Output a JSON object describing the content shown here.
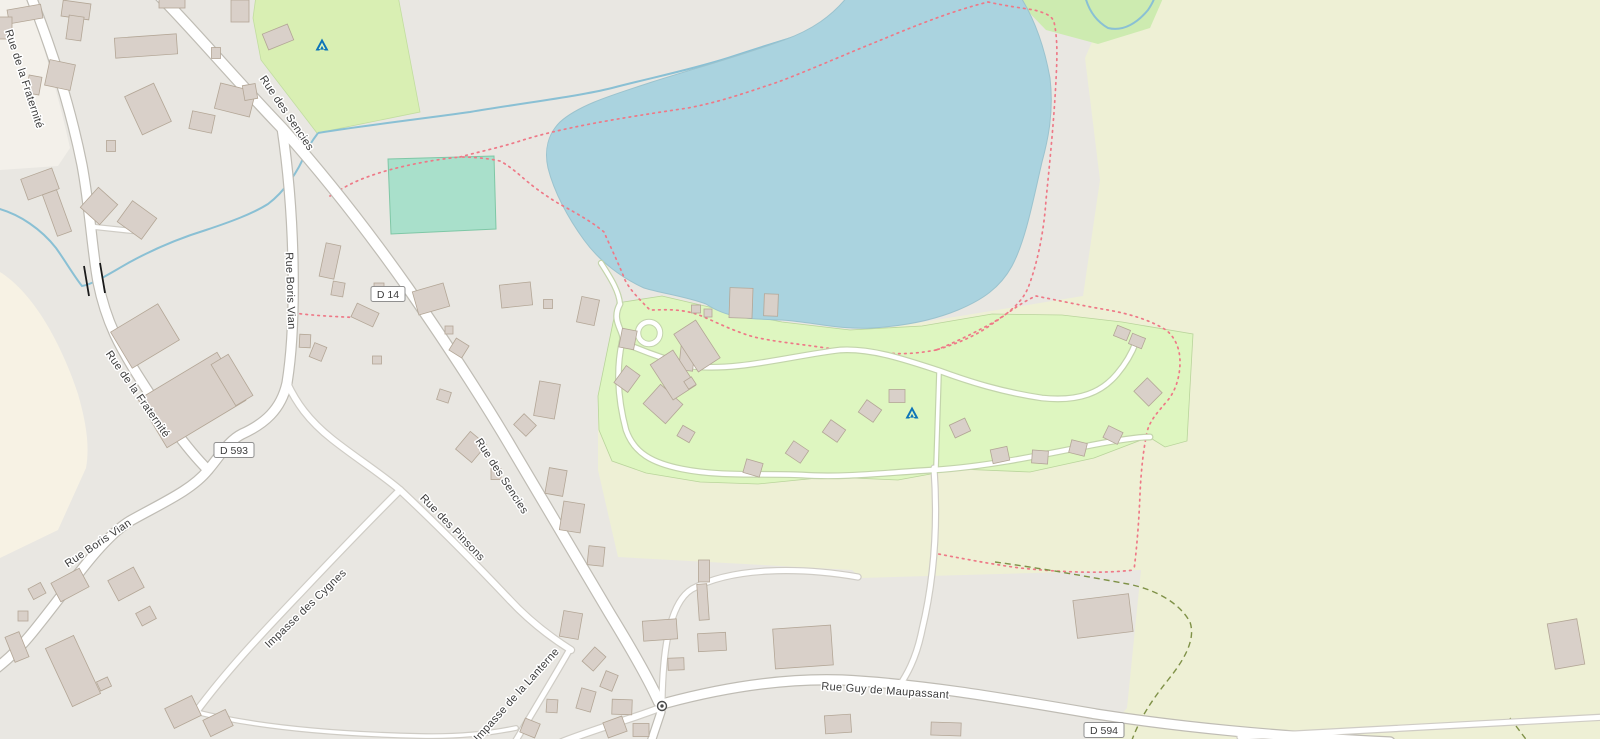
{
  "map": {
    "labels": [
      {
        "id": "fraternite-1",
        "text": "Rue de la Fraternité",
        "x": 21,
        "y": 80,
        "rot": 72
      },
      {
        "id": "fraternite-2",
        "text": "Rue de la Fraternité",
        "x": 135,
        "y": 396,
        "rot": 55
      },
      {
        "id": "sencies-1",
        "text": "Rue des Sencies",
        "x": 284,
        "y": 115,
        "rot": 56
      },
      {
        "id": "sencies-2",
        "text": "Rue des Sencies",
        "x": 499,
        "y": 478,
        "rot": 57
      },
      {
        "id": "boris-vian-1",
        "text": "Rue Boris Vian",
        "x": 287,
        "y": 291,
        "rot": 88
      },
      {
        "id": "boris-vian-2",
        "text": "Rue Boris Vian",
        "x": 100,
        "y": 546,
        "rot": -34
      },
      {
        "id": "pinsons",
        "text": "Rue des Pinsons",
        "x": 450,
        "y": 530,
        "rot": 46
      },
      {
        "id": "cygnes",
        "text": "Impasse des Cygnes",
        "x": 308,
        "y": 611,
        "rot": -44
      },
      {
        "id": "lanterne",
        "text": "Impasse de la Lanterne",
        "x": 519,
        "y": 697,
        "rot": -48
      },
      {
        "id": "maupassant",
        "text": "Rue Guy de Maupassant",
        "x": 885,
        "y": 694,
        "rot": 4
      }
    ],
    "shields": [
      {
        "id": "d14",
        "ref": "D 14",
        "x": 388,
        "y": 294,
        "w": 34,
        "h": 15
      },
      {
        "id": "d593",
        "ref": "D 593",
        "x": 234,
        "y": 450,
        "w": 40,
        "h": 15
      },
      {
        "id": "d594",
        "ref": "D 594",
        "x": 1104,
        "y": 730,
        "w": 40,
        "h": 15
      }
    ],
    "markers": {
      "campsites": [
        {
          "x": 322,
          "y": 45
        },
        {
          "x": 912,
          "y": 413
        }
      ],
      "mini_roundabout": {
        "x": 662,
        "y": 706
      }
    },
    "palette": {
      "base": "#e9e7e2",
      "light_area": "#f3f0ea",
      "cream": "#f7f2e4",
      "farmland": "#eef0d5",
      "campsite": "#def6c0",
      "grass": "#d9efb3",
      "grass2": "#cdebb0",
      "water": "#aad3df",
      "pitch": "#a9e0cb",
      "road_fill": "#ffffff",
      "road_casing": "#bfbcb4",
      "road_casing_minor": "#cfccc5",
      "path_casing_green": "#c3d4ab",
      "building": "#d9d0c9",
      "building_stroke": "#b3a696",
      "trail_red": "#ee7987",
      "hedge_green": "#7f9147",
      "stream": "#8ac0d4",
      "label": "#3c3c3c",
      "shield_border": "#909090",
      "tent_blue": "#0d74b8",
      "bridge": "#1a1a1a"
    }
  }
}
